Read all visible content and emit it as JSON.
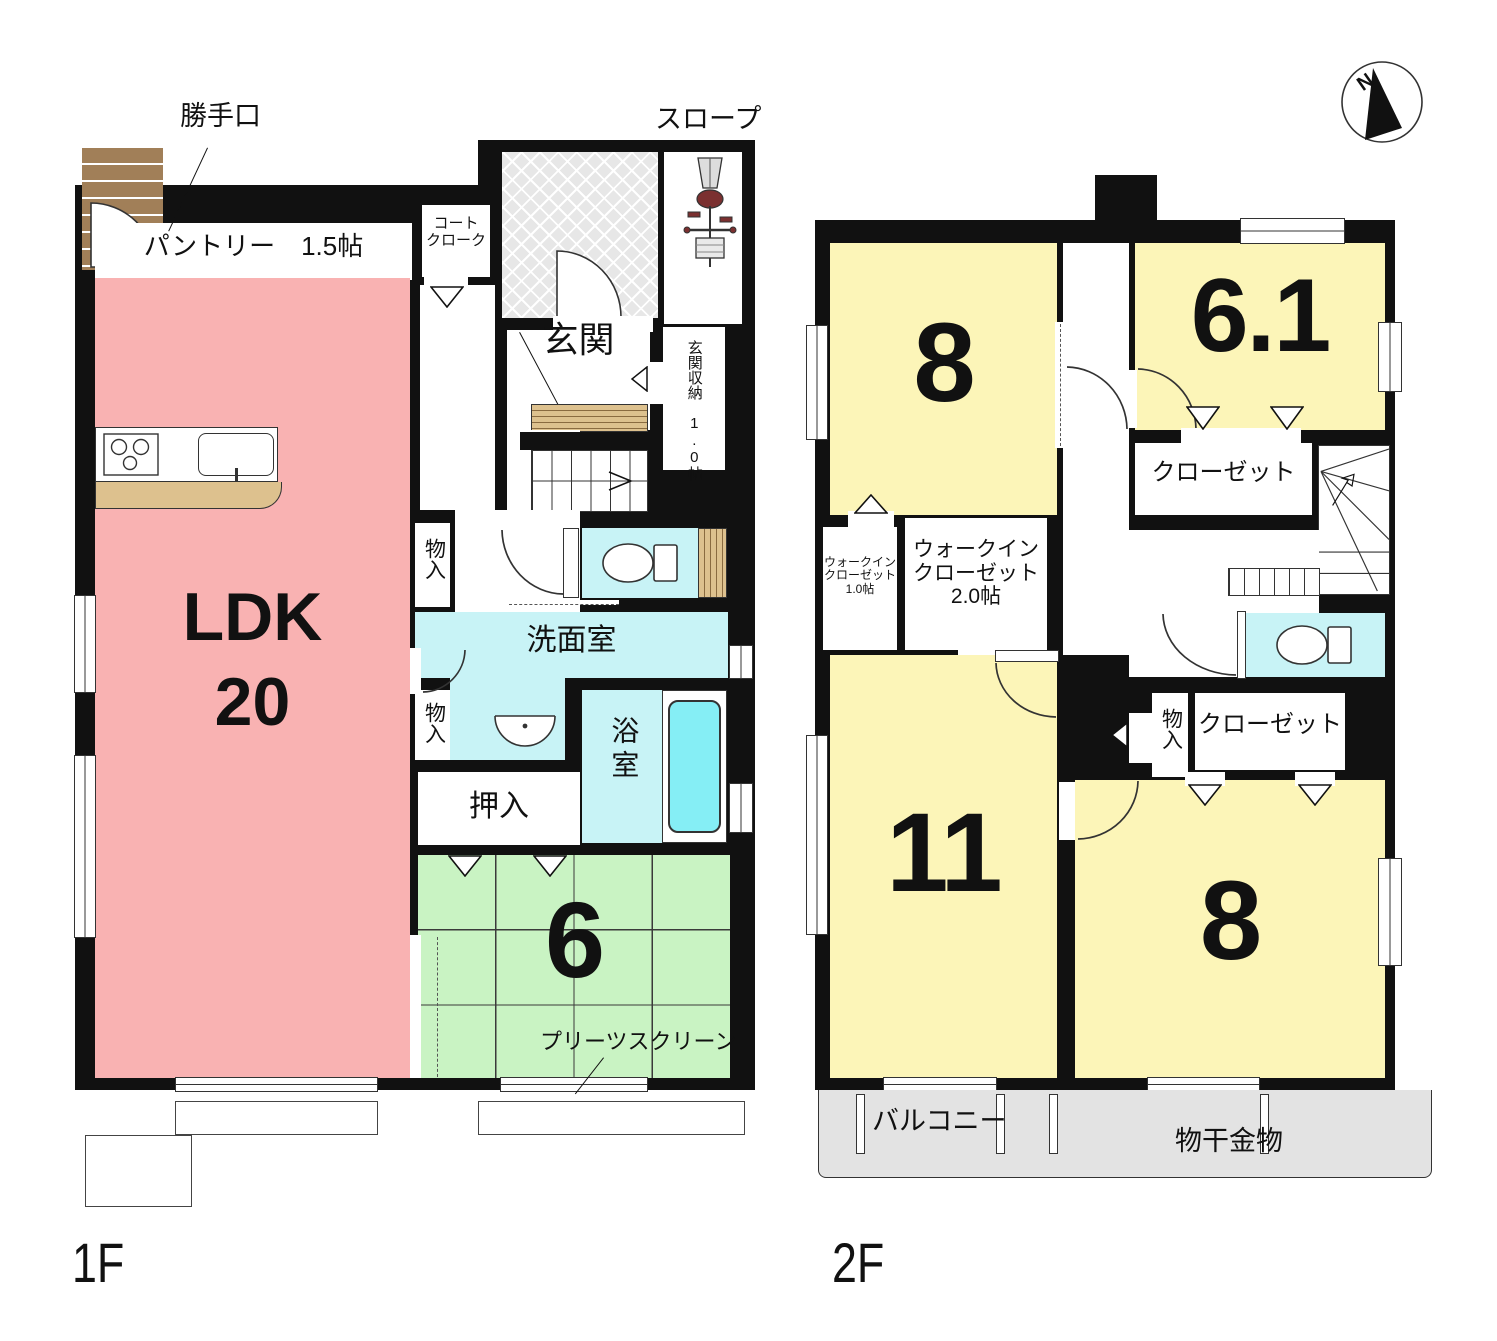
{
  "colors": {
    "wall": "#111111",
    "ldk_pink": "#f9b2b2",
    "tatami_green": "#c9f3c3",
    "room_yellow": "#fcf5b8",
    "water_cyan": "#c8f3f6",
    "tub_cyan": "#85eef5",
    "balcony_gray": "#e3e3e3",
    "wood_tan": "#ddc18e",
    "step_brown": "#a17f58",
    "porch_gray": "#e7e7e7"
  },
  "compass": {
    "north_label": "N"
  },
  "floor1": {
    "name": "1F",
    "labels": {
      "back_door": "勝手口",
      "pantry": "パントリー　1.5帖",
      "coat_closet_line1": "コート",
      "coat_closet_line2": "クローク",
      "slope": "スロープ",
      "entrance": "玄関",
      "entrance_storage": "玄関収納　1.0帖",
      "storage": "物入",
      "washroom": "洗面室",
      "bathroom": "浴室",
      "futon_closet": "押入",
      "tatami_size": "6",
      "pleats_screen": "プリーツスクリーン",
      "ldk": "LDK",
      "ldk_size": "20"
    }
  },
  "floor2": {
    "name": "2F",
    "labels": {
      "room8_top": "8",
      "room61": "6.1",
      "closet": "クローゼット",
      "wic_line1": "ウォークイン",
      "wic_line2": "クローゼット",
      "wic10_size": "1.0帖",
      "wic20_size": "2.0帖",
      "storage": "物入",
      "room11": "11",
      "room8_bottom": "8",
      "balcony": "バルコニー",
      "drying_hardware": "物干金物"
    }
  }
}
